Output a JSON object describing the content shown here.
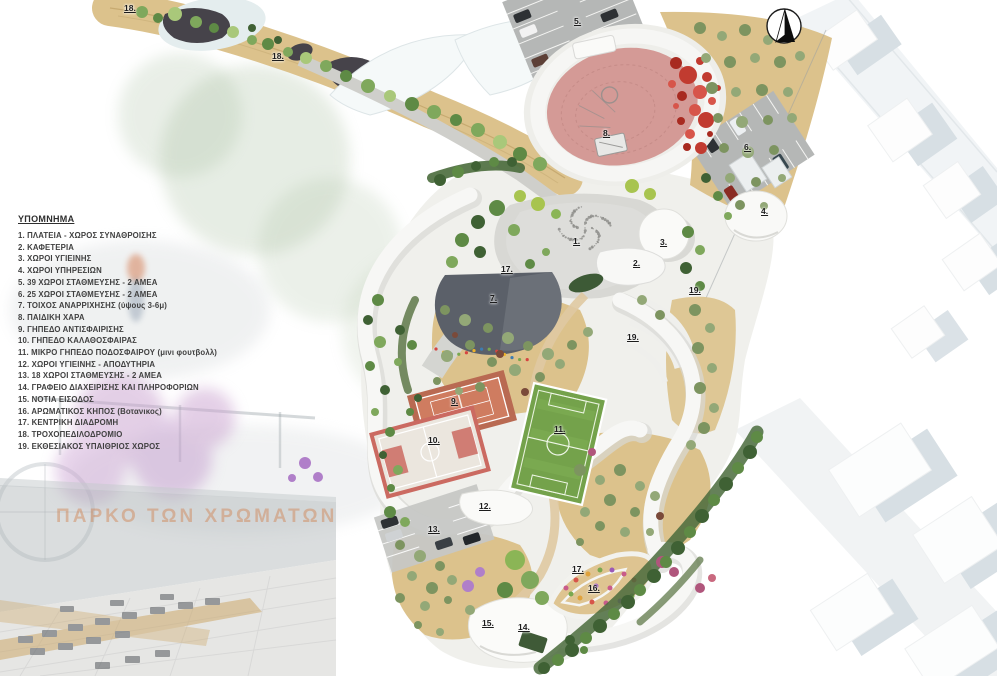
{
  "watermark": {
    "text": "ΠΑΡΚΟ ΤΩΝ ΧΡΩΜΑΤΩΝ"
  },
  "legend": {
    "title": "ΥΠΟΜΝΗΜΑ",
    "items": [
      "1. ΠΛΑΤΕΙΑ - ΧΩΡΟΣ ΣΥΝΑΘΡΟΙΣΗΣ",
      "2. ΚΑΦΕΤΕΡΙΑ",
      "3. ΧΩΡΟΙ ΥΓΙΕΙΝΗΣ",
      "4. ΧΩΡΟΙ ΥΠΗΡΕΣΙΩΝ",
      "5. 39 ΧΩΡΟΙ ΣΤΑΘΜΕΥΣΗΣ - 2 ΑΜΕΑ",
      "6. 25 ΧΩΡΟΙ ΣΤΑΘΜΕΥΣΗΣ - 2 ΑΜΕΑ",
      "7. ΤΟΙΧΟΣ ΑΝΑΡΡΙΧΗΣΗΣ (ύψους 3-6μ)",
      "8. ΠΑΙΔΙΚΗ ΧΑΡΑ",
      "9. ΓΗΠΕΔΟ ΑΝΤΙΣΦΑΙΡΙΣΗΣ",
      "10. ΓΗΠΕΔΟ ΚΑΛΑΘΟΣΦΑΙΡΑΣ",
      "11. ΜΙΚΡΟ ΓΗΠΕΔΟ ΠΟΔΟΣΦΑΙΡΟΥ (μινι φουτβολλ)",
      "12. ΧΩΡΟΙ ΥΓΙΕΙΝΗΣ - ΑΠΟΔΥΤΗΡΙΑ",
      "13. 18 ΧΩΡΟΙ ΣΤΑΘΜΕΥΣΗΣ - 2 ΑΜΕΑ",
      "14. ΓΡΑΦΕΙΟ ΔΙΑΧΕΙΡΙΣΗΣ ΚΑΙ ΠΛΗΡΟΦΟΡΙΩΝ",
      "15. ΝΟΤΙΑ ΕΙΣΟΔΟΣ",
      "16. ΑΡΩΜΑΤΙΚΟΣ ΚΗΠΟΣ (Βοτανικος)",
      "17. ΚΕΝΤΡΙΚΗ ΔΙΑΔΡΟΜΗ",
      "18. ΤΡΟΧΟΠΕΔΙΛΟΔΡΟΜΙΟ",
      "19. ΕΚΘΕΣΙΑΚΟΣ ΥΠΑΙΘΡΙΟΣ ΧΩΡΟΣ"
    ]
  },
  "plan_markers": [
    {
      "text": "18.",
      "x": 124,
      "y": 4
    },
    {
      "text": "5.",
      "x": 574,
      "y": 17
    },
    {
      "text": "18.",
      "x": 272,
      "y": 52
    },
    {
      "text": "8.",
      "x": 603,
      "y": 129
    },
    {
      "text": "6.",
      "x": 744,
      "y": 143
    },
    {
      "text": "4.",
      "x": 761,
      "y": 207
    },
    {
      "text": "1.",
      "x": 573,
      "y": 237
    },
    {
      "text": "3.",
      "x": 660,
      "y": 238
    },
    {
      "text": "2.",
      "x": 633,
      "y": 259
    },
    {
      "text": "17.",
      "x": 501,
      "y": 265
    },
    {
      "text": "19.",
      "x": 689,
      "y": 286
    },
    {
      "text": "7.",
      "x": 490,
      "y": 294
    },
    {
      "text": "19.",
      "x": 627,
      "y": 333
    },
    {
      "text": "9.",
      "x": 451,
      "y": 397
    },
    {
      "text": "11.",
      "x": 554,
      "y": 425
    },
    {
      "text": "10.",
      "x": 428,
      "y": 436
    },
    {
      "text": "12.",
      "x": 479,
      "y": 502
    },
    {
      "text": "13.",
      "x": 428,
      "y": 525
    },
    {
      "text": "17.",
      "x": 572,
      "y": 565
    },
    {
      "text": "16.",
      "x": 588,
      "y": 584
    },
    {
      "text": "15.",
      "x": 482,
      "y": 619
    },
    {
      "text": "14.",
      "x": 518,
      "y": 623
    }
  ],
  "icons": {
    "north": "north-arrow-icon"
  },
  "colors": {
    "playground_pink": "#d49a96",
    "ball_red": "#c13b30",
    "field_green": "#74a24b",
    "tennis_clay": "#cd7a5e",
    "court_trim_red": "#cb6a61",
    "sand": "#dcc28c",
    "climbing_wall_slate": "#5b6069",
    "watermark_orange": "#cf7a42"
  }
}
